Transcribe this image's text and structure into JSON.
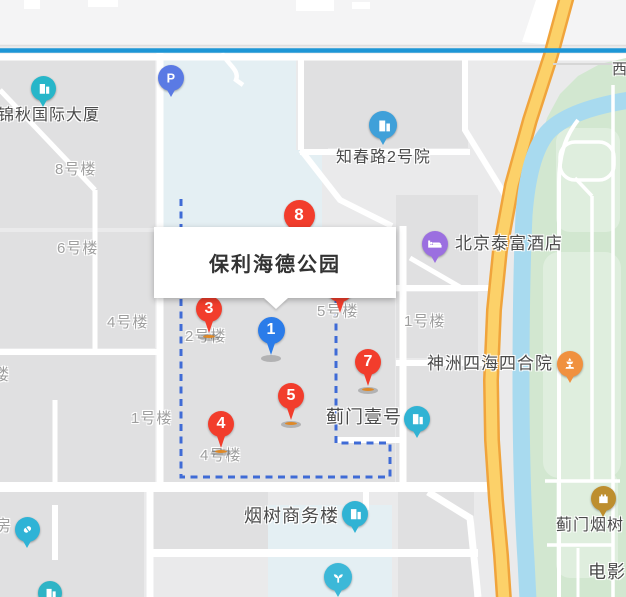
{
  "map": {
    "info_card": {
      "title": "保利海德公园"
    },
    "colors": {
      "metro_line": "#1d96d6",
      "road_yellow_fill": "#fcd169",
      "road_yellow_border": "#f0a43c",
      "river": "#a8daef",
      "park_green": "#d2e7d0",
      "boundary_dash": "#3f6bd6",
      "pin_red": "#f23d2c",
      "pin_blue": "#2b7ce9",
      "block_blue_tint": "#e4eff3"
    },
    "labels": [
      {
        "name": "label-8haolou",
        "text": "8号楼",
        "x": 55,
        "y": 162,
        "fs": 15,
        "style": "minor"
      },
      {
        "name": "label-6haolou",
        "text": "6号楼",
        "x": 57,
        "y": 241,
        "fs": 15,
        "style": "minor"
      },
      {
        "name": "label-4haolou-west",
        "text": "4号楼",
        "x": 107,
        "y": 315,
        "fs": 15,
        "style": "minor"
      },
      {
        "name": "label-lou-partial",
        "text": "楼",
        "x": -7,
        "y": 367,
        "fs": 16,
        "style": "minor"
      },
      {
        "name": "label-1haolou-west",
        "text": "1号楼",
        "x": 131,
        "y": 411,
        "fs": 15,
        "style": "minor"
      },
      {
        "name": "label-2haolou",
        "text": "2号楼",
        "x": 185,
        "y": 329,
        "fs": 15,
        "style": "minor"
      },
      {
        "name": "label-5haolou",
        "text": "5号楼",
        "x": 317,
        "y": 304,
        "fs": 15,
        "style": "minor"
      },
      {
        "name": "label-4haolou-estate",
        "text": "4号楼",
        "x": 200,
        "y": 448,
        "fs": 15,
        "style": "minor"
      },
      {
        "name": "label-1haolou-east",
        "text": "1号楼",
        "x": 404,
        "y": 314,
        "fs": 15,
        "style": "minor"
      },
      {
        "name": "label-fang-partial",
        "text": "房",
        "x": -5,
        "y": 518,
        "fs": 16,
        "style": "minor"
      },
      {
        "name": "label-jinqiu-tower",
        "text": "锦秋国际大厦",
        "x": -2,
        "y": 107,
        "fs": 16,
        "style": "poi"
      },
      {
        "name": "label-zhichunlu-2",
        "text": "知春路2号院",
        "x": 336,
        "y": 149,
        "fs": 16,
        "style": "poi"
      },
      {
        "name": "label-taifu-hotel",
        "text": "北京泰富酒店",
        "x": 455,
        "y": 235,
        "fs": 17,
        "style": "poi"
      },
      {
        "name": "label-shenzhou-sihai",
        "text": "神洲四海四合院",
        "x": 427,
        "y": 355,
        "fs": 17,
        "style": "poi"
      },
      {
        "name": "label-jimen-yihao",
        "text": "蓟门壹号",
        "x": 326,
        "y": 408,
        "fs": 18,
        "style": "poi"
      },
      {
        "name": "label-yanshu-plaza",
        "text": "烟树商务楼",
        "x": 244,
        "y": 507,
        "fs": 18,
        "style": "poi"
      },
      {
        "name": "label-jimen-yanshu",
        "text": "蓟门烟树",
        "x": 556,
        "y": 517,
        "fs": 16,
        "style": "poi"
      },
      {
        "name": "label-dianying",
        "text": "电影",
        "x": 588,
        "y": 563,
        "fs": 18,
        "style": "poi"
      },
      {
        "name": "label-xi-road",
        "text": "西",
        "x": 612,
        "y": 62,
        "fs": 15,
        "style": "poi"
      }
    ],
    "numbered_markers": [
      {
        "name": "marker-8",
        "label": "8",
        "x": 299,
        "y": 215,
        "r": 15.5,
        "color": "#f23d2c",
        "shadow": false
      },
      {
        "name": "marker-2",
        "label": "2",
        "x": 340,
        "y": 289,
        "r": 13,
        "color": "#f23d2c",
        "shadow": false
      },
      {
        "name": "marker-3",
        "label": "3",
        "x": 209,
        "y": 309,
        "r": 13,
        "color": "#f23d2c",
        "shadow": true
      },
      {
        "name": "marker-1",
        "label": "1",
        "x": 271,
        "y": 330,
        "r": 13.5,
        "color": "#2b7ce9",
        "shadow": true
      },
      {
        "name": "marker-7",
        "label": "7",
        "x": 368,
        "y": 362,
        "r": 13,
        "color": "#f23d2c",
        "shadow": true
      },
      {
        "name": "marker-5",
        "label": "5",
        "x": 291,
        "y": 396,
        "r": 13,
        "color": "#f23d2c",
        "shadow": true
      },
      {
        "name": "marker-4",
        "label": "4",
        "x": 221,
        "y": 424,
        "r": 13,
        "color": "#f23d2c",
        "shadow": true
      }
    ],
    "poi_markers": [
      {
        "name": "marker-parking",
        "icon": "parking-icon",
        "x": 171,
        "y": 78,
        "r": 13,
        "color": "#5a7ae4"
      },
      {
        "name": "marker-jinqiu-building",
        "icon": "building-icon",
        "x": 43,
        "y": 88,
        "r": 12.5,
        "color": "#27b6c9"
      },
      {
        "name": "marker-zhichun-building",
        "icon": "building-icon",
        "x": 383,
        "y": 125,
        "r": 14,
        "color": "#3fa0d9"
      },
      {
        "name": "marker-taifu-hotel",
        "icon": "bed-icon",
        "x": 435,
        "y": 244,
        "r": 13,
        "color": "#9b6fe0"
      },
      {
        "name": "marker-shenzhou",
        "icon": "pavilion-icon",
        "x": 570,
        "y": 364,
        "r": 13,
        "color": "#f0913f"
      },
      {
        "name": "marker-jimen-yihao",
        "icon": "building-icon",
        "x": 417,
        "y": 419,
        "r": 13,
        "color": "#30b3d4"
      },
      {
        "name": "marker-yanshu-plaza",
        "icon": "building-icon",
        "x": 355,
        "y": 514,
        "r": 13,
        "color": "#30b3d4"
      },
      {
        "name": "marker-restaurant",
        "icon": "sprout-icon",
        "x": 338,
        "y": 577,
        "r": 14,
        "color": "#3cb8d8"
      },
      {
        "name": "marker-pharmacy",
        "icon": "pill-icon",
        "x": 27,
        "y": 529,
        "r": 12.5,
        "color": "#2fb3d6"
      },
      {
        "name": "marker-corner-building",
        "icon": "building-icon",
        "x": 50,
        "y": 593,
        "r": 12,
        "color": "#2fb4c6"
      },
      {
        "name": "marker-jimen-yanshu",
        "icon": "castle-icon",
        "x": 603,
        "y": 498,
        "r": 12.5,
        "color": "#bd8e2e"
      }
    ]
  }
}
